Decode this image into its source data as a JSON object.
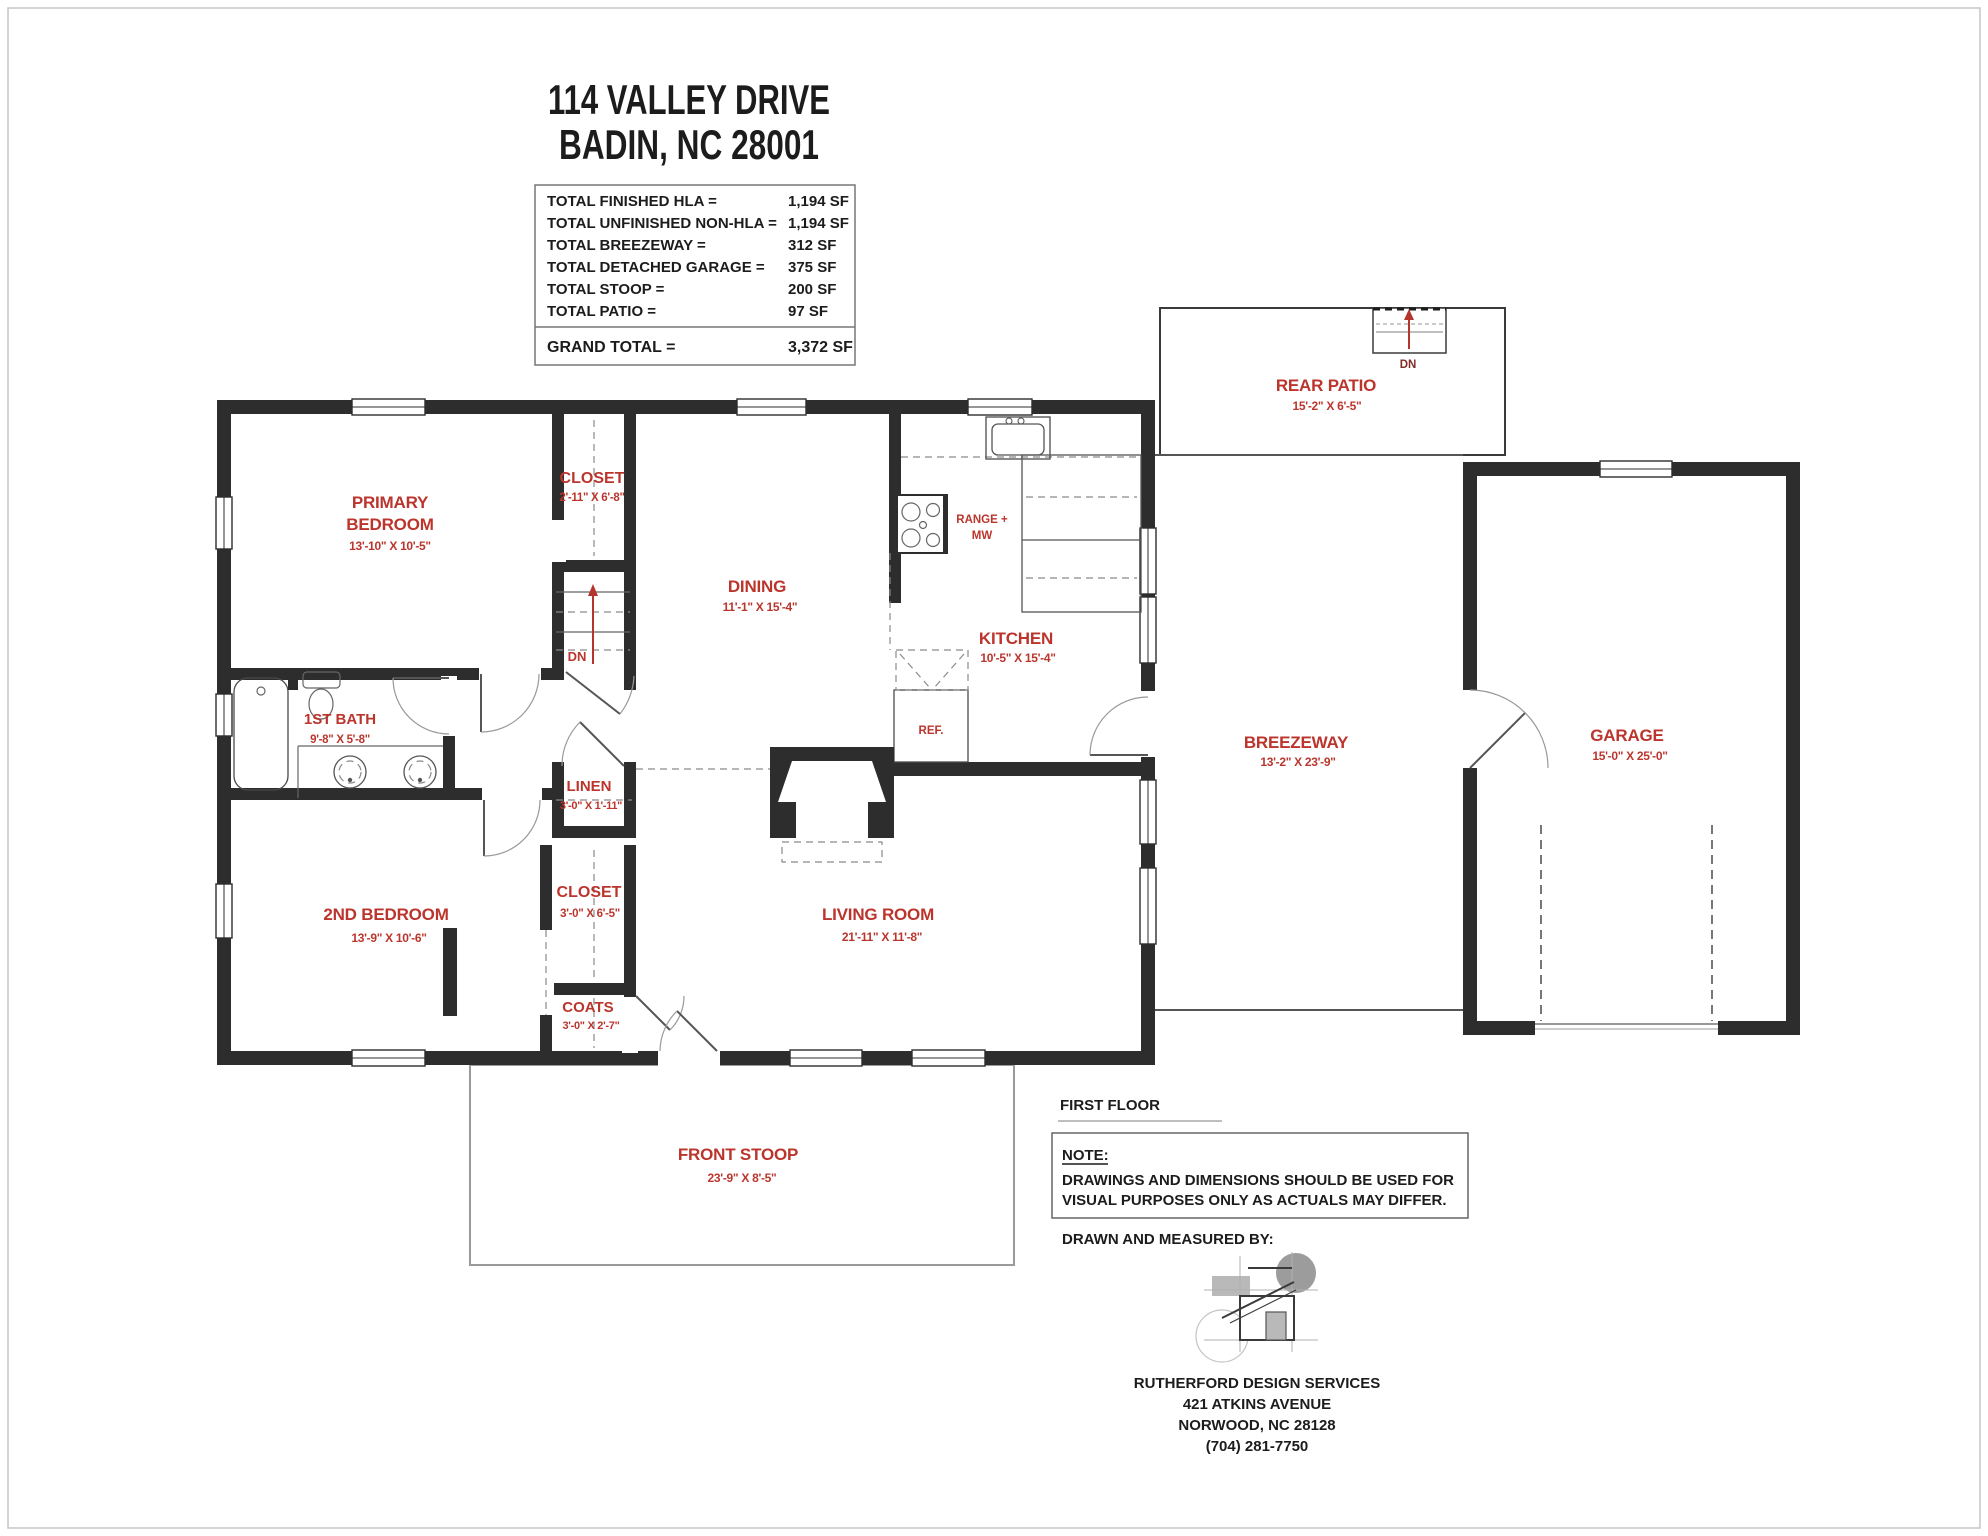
{
  "header": {
    "address_line1": "114 VALLEY DRIVE",
    "address_line2": "BADIN, NC 28001"
  },
  "area_table": {
    "rows": [
      {
        "label": "TOTAL FINISHED HLA =",
        "value": "1,194 SF"
      },
      {
        "label": "TOTAL UNFINISHED NON-HLA =",
        "value": "1,194 SF"
      },
      {
        "label": "TOTAL BREEZEWAY =",
        "value": "312 SF"
      },
      {
        "label": "TOTAL DETACHED GARAGE =",
        "value": "375 SF"
      },
      {
        "label": "TOTAL STOOP =",
        "value": "200 SF"
      },
      {
        "label": "TOTAL PATIO =",
        "value": "97 SF"
      }
    ],
    "grand_total_label": "GRAND TOTAL =",
    "grand_total_value": "3,372 SF"
  },
  "rooms": {
    "primary_bedroom": {
      "line1": "PRIMARY",
      "line2": "BEDROOM",
      "dims": "13'-10\" X 10'-5\""
    },
    "closet_primary": {
      "label": "CLOSET",
      "dims": "2'-11\" X 6'-8\""
    },
    "dining": {
      "label": "DINING",
      "dims": "11'-1\" X 15'-4\""
    },
    "kitchen": {
      "label": "KITCHEN",
      "dims": "10'-5\" X 15'-4\""
    },
    "first_bath": {
      "label": "1ST BATH",
      "dims": "9'-8\" X 5'-8\""
    },
    "linen": {
      "label": "LINEN",
      "dims": "3'-0\" X 1'-11\""
    },
    "second_bedroom": {
      "label": "2ND BEDROOM",
      "dims": "13'-9\" X 10'-6\""
    },
    "closet_hall": {
      "label": "CLOSET",
      "dims": "3'-0\" X 6'-5\""
    },
    "coats": {
      "label": "COATS",
      "dims": "3'-0\" X 2'-7\""
    },
    "living_room": {
      "label": "LIVING ROOM",
      "dims": "21'-11\" X 11'-8\""
    },
    "breezeway": {
      "label": "BREEZEWAY",
      "dims": "13'-2\" X 23'-9\""
    },
    "garage": {
      "label": "GARAGE",
      "dims": "15'-0\" X 25'-0\""
    },
    "rear_patio": {
      "label": "REAR PATIO",
      "dims": "15'-2\" X 6'-5\""
    },
    "front_stoop": {
      "label": "FRONT STOOP",
      "dims": "23'-9\" X 8'-5\""
    }
  },
  "fixtures": {
    "range_line1": "RANGE +",
    "range_line2": "MW",
    "fridge": "REF.",
    "stairs_down": "DN",
    "patio_steps_down": "DN"
  },
  "annotations": {
    "floor_label": "FIRST FLOOR",
    "note_title": "NOTE:",
    "note_line1": "DRAWINGS AND DIMENSIONS SHOULD BE USED FOR",
    "note_line2": "VISUAL PURPOSES ONLY AS ACTUALS MAY DIFFER.",
    "drawn_by": "DRAWN AND MEASURED BY:",
    "firm_name": "RUTHERFORD DESIGN SERVICES",
    "firm_address": "421 ATKINS AVENUE",
    "firm_city": "NORWOOD, NC 28128",
    "firm_phone": "(704) 281-7750"
  },
  "colors": {
    "label_red": "#bb352d",
    "dark_red": "#7e2c24",
    "wall": "#2d2d2d",
    "text": "#1c1c1c"
  }
}
